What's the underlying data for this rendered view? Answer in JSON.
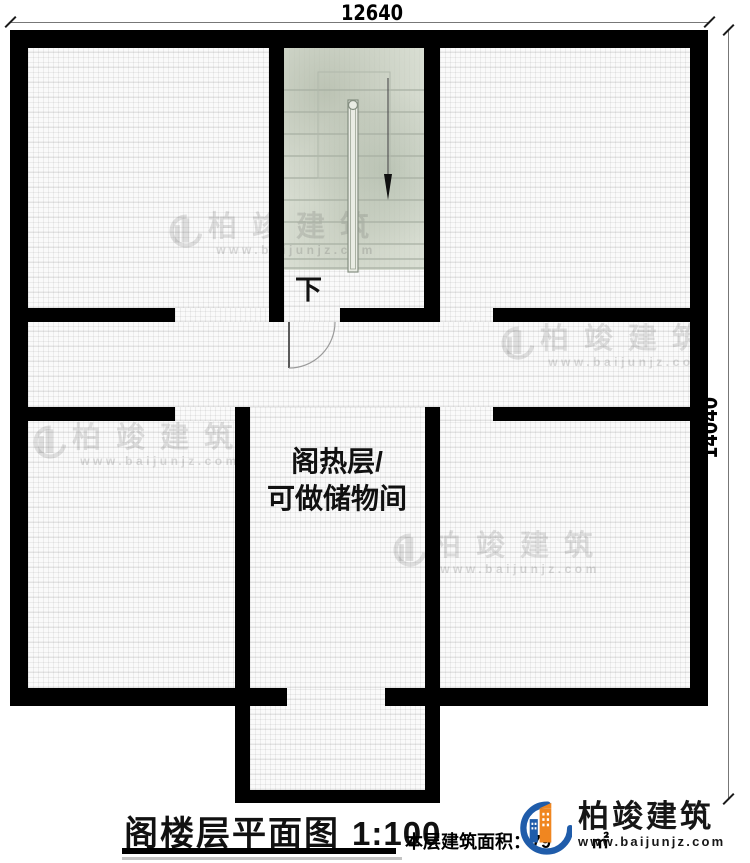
{
  "plan": {
    "dim_top": "12640",
    "dim_right": "14040",
    "stair_down_label": "下",
    "central_room_label_line1": "阁热层/",
    "central_room_label_line2": "可做储物间"
  },
  "watermark": {
    "brand": "柏竣建筑",
    "url": "www.baijunjz.com"
  },
  "footer": {
    "title": "阁楼层平面图",
    "scale": "1:100",
    "area_label": "本层建筑面积：",
    "area_value": "79",
    "area_unit": "㎡"
  },
  "logo": {
    "brand": "柏竣建筑",
    "url": "www.baijunjz.com"
  },
  "colors": {
    "wall": "#000000",
    "stair_bg": "#dbe0d5",
    "logo_blue": "#1f5caa",
    "logo_orange": "#f08620"
  }
}
